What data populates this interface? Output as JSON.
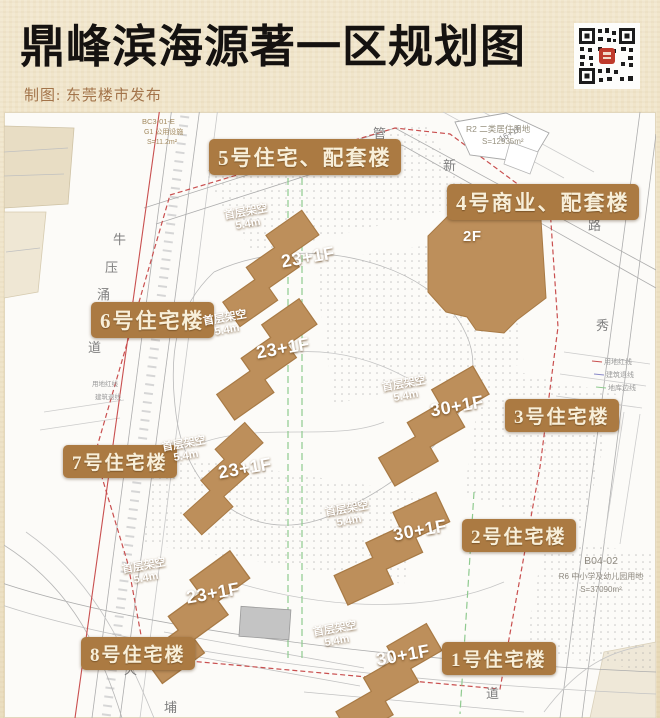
{
  "header": {
    "title": "鼎峰滨海源著一区规划图",
    "credit": "制图: 东莞楼市发布"
  },
  "buildings": [
    {
      "name": "1号住宅楼",
      "floors": "30+1F",
      "stilt": "首层架空",
      "stilt_height": "5.4m"
    },
    {
      "name": "2号住宅楼",
      "floors": "30+1F",
      "stilt": "首层架空",
      "stilt_height": "5.4m"
    },
    {
      "name": "3号住宅楼",
      "floors": "30+1F",
      "stilt": "首层架空",
      "stilt_height": "5.4m"
    },
    {
      "name": "4号商业、配套楼",
      "floors": "2F"
    },
    {
      "name": "5号住宅、配套楼",
      "floors": "23+1F",
      "stilt": "首层架空",
      "stilt_height": "5.4m"
    },
    {
      "name": "6号住宅楼",
      "floors": "23+1F",
      "stilt": "首层架空",
      "stilt_height": "5.4m"
    },
    {
      "name": "7号住宅楼",
      "floors": "23+1F",
      "stilt": "首层架空",
      "stilt_height": "5.4m"
    },
    {
      "name": "8号住宅楼",
      "floors": "23+1F",
      "stilt": "首层架空",
      "stilt_height": "5.4m"
    }
  ],
  "parcels": [
    {
      "code": "BC3-01-E",
      "use": "G1 公用设施",
      "area": "S=11.2m²"
    },
    {
      "code": "R2 二类居住用地",
      "area": "S=12935m²"
    },
    {
      "code": "B04-02",
      "use": "R6 中小学及幼儿园用地",
      "area": "S=37090m²"
    }
  ],
  "adjacent_building_floors": "16+1F",
  "legend": {
    "right": [
      "用地红线",
      "建筑退线",
      "地库边线"
    ],
    "left": [
      "用地红线",
      "建筑退线"
    ]
  },
  "road_chars": [
    "牛",
    "压",
    "涌",
    "道",
    "管",
    "围",
    "新",
    "路",
    "秀",
    "天",
    "埔",
    "道"
  ],
  "icons": {
    "qr": "qr-code"
  },
  "colors": {
    "bronze_tag": "#ab7a42",
    "building_fill": "#bd8f5b",
    "cream_text": "#f8efd9",
    "red_line": "#c94f4f",
    "green_line": "#8fca8f",
    "header_bg": "#eee1c4",
    "title_ink": "#151210",
    "credit_text": "#a3744a"
  }
}
